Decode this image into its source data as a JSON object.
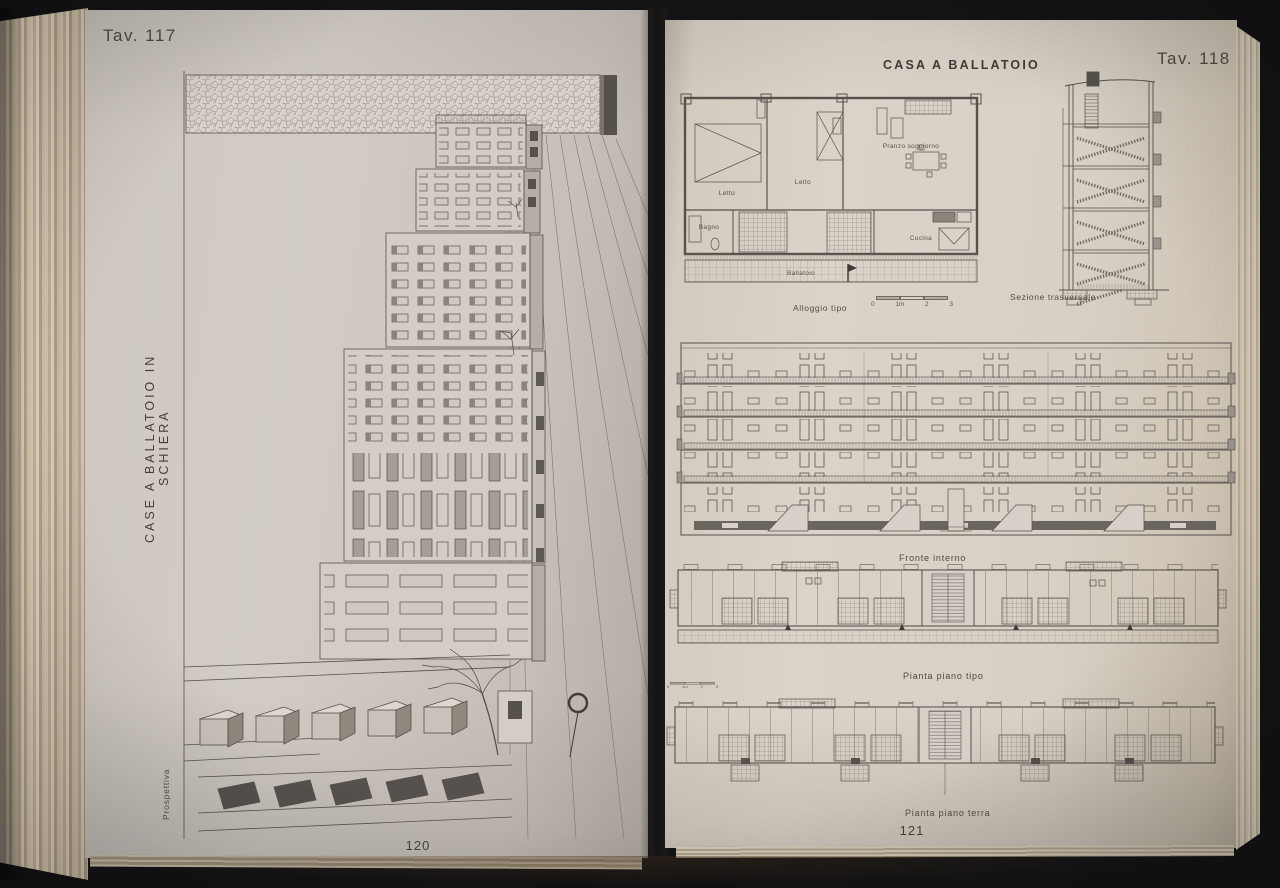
{
  "book": {
    "left_page": {
      "plate_label": "Tav. 117",
      "side_title": "CASE A BALLATOIO IN SCHIERA",
      "drawing_caption": "Prospettiva",
      "page_number": "120"
    },
    "right_page": {
      "header_title": "CASA A BALLATOIO",
      "plate_label": "Tav. 118",
      "apartment_plan": {
        "caption": "Alloggio tipo",
        "room_labels": {
          "letto1": "Letto",
          "letto2": "Letto",
          "pranzo": "Pranzo soggiorno",
          "bagno": "Bagno",
          "cucina": "Cucina",
          "ballatoio": "Ballatoio"
        },
        "scale_labels": [
          "0",
          "1m",
          "2",
          "3"
        ]
      },
      "section_caption": "Sezione trasversale",
      "elevation_caption": "Fronte interno",
      "typical_plan_caption": "Pianta piano tipo",
      "typical_plan_scale_labels": [
        "0",
        "1m",
        "2",
        "3"
      ],
      "ground_plan_caption": "Pianta piano terra",
      "page_number": "121"
    }
  },
  "colors": {
    "background": "#131315",
    "left_page": "#cdc6c0",
    "right_page": "#d7d0c5",
    "ink": "#56514c",
    "dark_fill": "#57524d"
  }
}
